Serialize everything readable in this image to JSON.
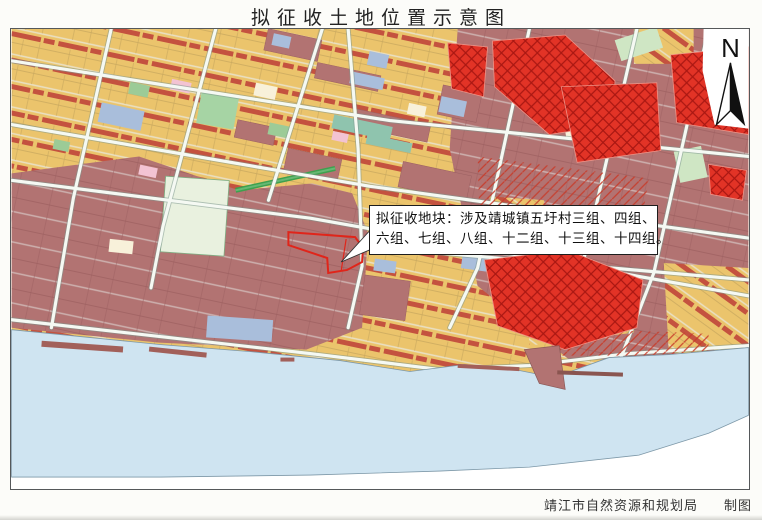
{
  "title": "拟征收土地位置示意图",
  "map": {
    "callout": {
      "line1": "拟征收地块：涉及靖城镇五圩村三组、四组、",
      "line2": "六组、七组、八组、十二组、十三组、十四组。"
    },
    "north": {
      "label": "N"
    },
    "attribution": {
      "agency": "靖江市自然资源和规划局",
      "credit": "制图"
    }
  },
  "colors": {
    "water": "#cfe4f1",
    "land_tan": "#ebc46c",
    "building_strip": "#c4523f",
    "mauve": "#b27372",
    "red_zone": "#e23326",
    "parcel_outline": "#e0251a",
    "road_fill": "#f5f9f3"
  }
}
